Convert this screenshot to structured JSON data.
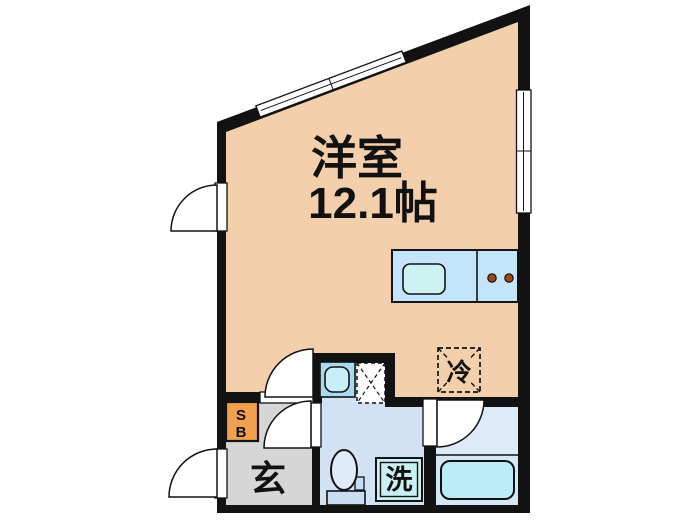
{
  "labels": {
    "room_name": "洋室",
    "room_size": "12.1帖",
    "fridge": "冷",
    "entrance": "玄",
    "washer": "洗",
    "shoebox_top": "S",
    "shoebox_bottom": "B"
  },
  "colors": {
    "wall": "#121212",
    "main_room": "#f3d0ab",
    "entrance_floor": "#d6d6d6",
    "shoebox": "#f0a04e",
    "sanitary_floor": "#d2e2f5",
    "bathroom_floor": "#ddeafa",
    "bath_zone": "#d3e7f8",
    "bathtub": "#baedf6",
    "counter": "#c4e4f9",
    "kitchen_sink": "#ccf2f2",
    "washbasin": "#a8daf0",
    "washbasin_bowl": "#c8eef7",
    "washer_box": "#c9f0f4",
    "toilet_bowl": "#dfeafa",
    "toilet_tank": "#c8dcf2",
    "utility_box": "#ffffff",
    "door_fill": "#ffffff",
    "window_fill": "#ffffff",
    "burner": "#9a4a12",
    "text": "#111111"
  }
}
